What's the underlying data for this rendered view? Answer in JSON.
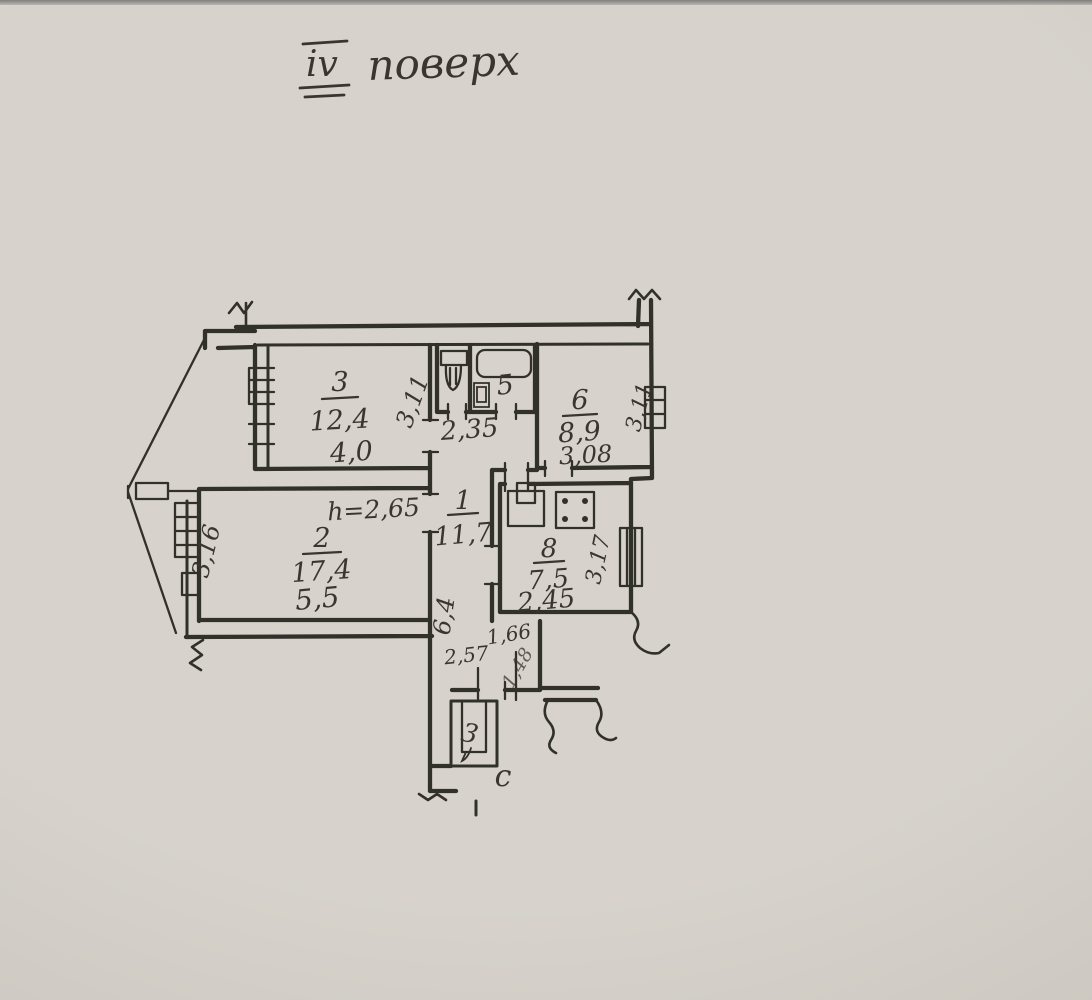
{
  "colors": {
    "paper": "#d7d3cc",
    "ink": "#32302b",
    "pencil": "#3a362f"
  },
  "title": {
    "roman": "IV",
    "word": "поверх"
  },
  "plan": {
    "height_note": "h=2,65",
    "north": "с",
    "rooms": {
      "r1": {
        "number": "1",
        "area": "11,7",
        "length": "6,4"
      },
      "r2": {
        "number": "2",
        "area": "17,4",
        "width": "5,5",
        "depth": "3,16"
      },
      "r3": {
        "number": "3",
        "area": "12,4",
        "width": "4,0",
        "depth": "3,11"
      },
      "r5": {
        "number": "5"
      },
      "r6": {
        "number": "6",
        "area": "8,9",
        "width": "3,08",
        "depth": "3,11"
      },
      "r8": {
        "number": "8",
        "area": "7,5",
        "width": "2,45",
        "depth": "3,17"
      }
    },
    "hall": {
      "width": "2,35"
    },
    "entry": {
      "dim_a": "1,66",
      "dim_b": "2,57",
      "dim_c": "1,48"
    },
    "balcony_mark": "3"
  }
}
